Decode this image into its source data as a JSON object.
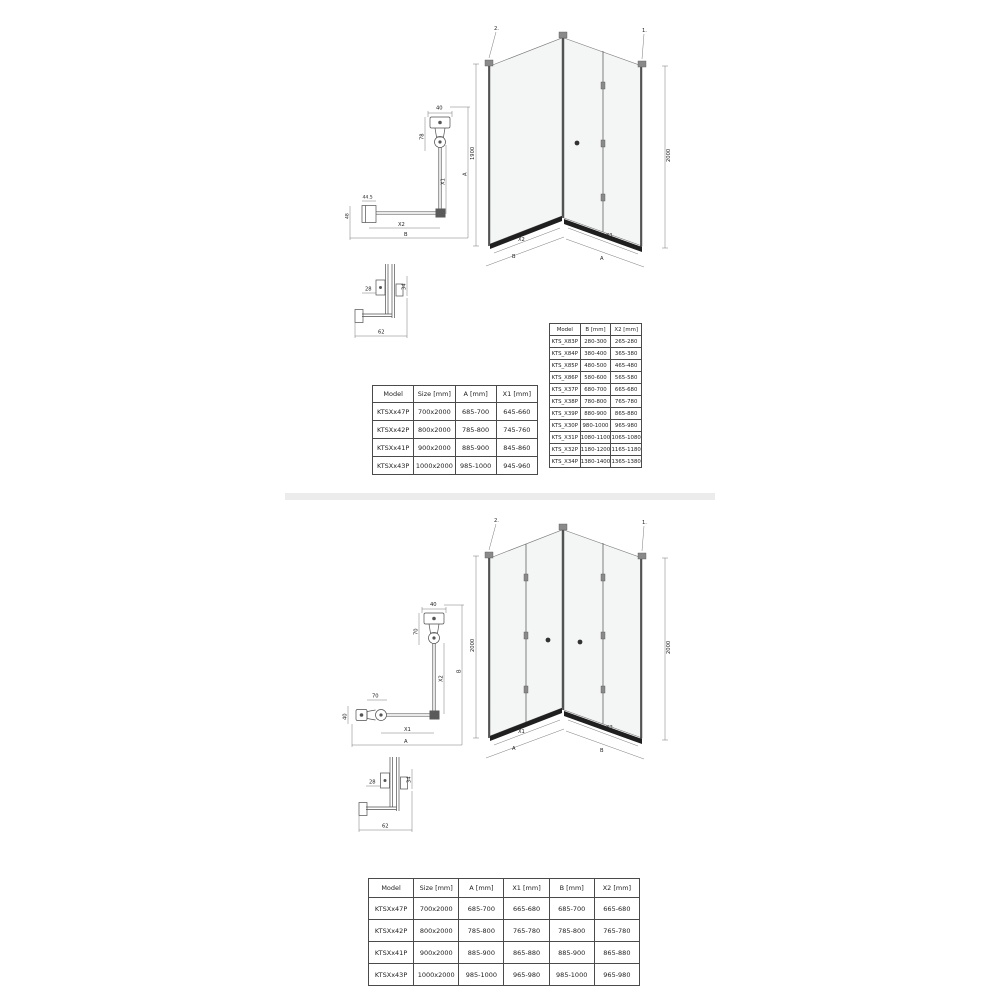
{
  "section_top": {
    "iso": {
      "step_left": "2.",
      "step_right": "1.",
      "height_left": "1900",
      "height_right": "2000",
      "dim_left_inner": "X2",
      "dim_left_outer": "B",
      "dim_right_inner": "X1",
      "dim_right_outer": "A"
    },
    "plan": {
      "top_width": "40",
      "hinge_depth": "78",
      "entry": "X1",
      "overall_right": "A",
      "profile_width": "44.5",
      "profile_depth": "48",
      "inner_bottom": "X2",
      "overall_bottom": "B"
    },
    "joint": {
      "left": "28",
      "right": "34",
      "bottom": "62"
    },
    "door_table": {
      "headers": [
        "Model",
        "Size [mm]",
        "A [mm]",
        "X1 [mm]"
      ],
      "rows": [
        [
          "KTSXx47P",
          "700x2000",
          "685-700",
          "645-660"
        ],
        [
          "KTSXx42P",
          "800x2000",
          "785-800",
          "745-760"
        ],
        [
          "KTSXx41P",
          "900x2000",
          "885-900",
          "845-860"
        ],
        [
          "KTSXx43P",
          "1000x2000",
          "985-1000",
          "945-960"
        ]
      ]
    },
    "wall_table": {
      "headers": [
        "Model",
        "B [mm]",
        "X2 [mm]"
      ],
      "rows": [
        [
          "KTS_X83P",
          "280-300",
          "265-280"
        ],
        [
          "KTS_X84P",
          "380-400",
          "365-380"
        ],
        [
          "KTS_X85P",
          "480-500",
          "465-480"
        ],
        [
          "KTS_X86P",
          "580-600",
          "565-580"
        ],
        [
          "KTS_X37P",
          "680-700",
          "665-680"
        ],
        [
          "KTS_X38P",
          "780-800",
          "765-780"
        ],
        [
          "KTS_X39P",
          "880-900",
          "865-880"
        ],
        [
          "KTS_X30P",
          "980-1000",
          "965-980"
        ],
        [
          "KTS_X31P",
          "1080-1100",
          "1065-1080"
        ],
        [
          "KTS_X32P",
          "1180-1200",
          "1165-1180"
        ],
        [
          "KTS_X34P",
          "1380-1400",
          "1365-1380"
        ]
      ]
    }
  },
  "section_bottom": {
    "iso": {
      "step_left": "2.",
      "step_right": "1.",
      "height_left": "2000",
      "height_right": "2000",
      "dim_left_inner": "X1",
      "dim_left_outer": "A",
      "dim_right_inner": "X2",
      "dim_right_outer": "B"
    },
    "plan": {
      "top_width": "40",
      "hinge_depth": "70",
      "left_hinge_width": "70",
      "left_profile_depth": "40",
      "inner_bottom": "X1",
      "overall_bottom": "A",
      "inner_right": "X2",
      "overall_right": "B"
    },
    "joint": {
      "left": "28",
      "right": "34",
      "bottom": "62"
    },
    "combo_table": {
      "headers": [
        "Model",
        "Size [mm]",
        "A [mm]",
        "X1 [mm]",
        "B [mm]",
        "X2 [mm]"
      ],
      "rows": [
        [
          "KTSXx47P",
          "700x2000",
          "685-700",
          "665-680",
          "685-700",
          "665-680"
        ],
        [
          "KTSXx42P",
          "800x2000",
          "785-800",
          "765-780",
          "785-800",
          "765-780"
        ],
        [
          "KTSXx41P",
          "900x2000",
          "885-900",
          "865-880",
          "885-900",
          "865-880"
        ],
        [
          "KTSXx43P",
          "1000x2000",
          "985-1000",
          "965-980",
          "985-1000",
          "965-980"
        ]
      ]
    }
  }
}
